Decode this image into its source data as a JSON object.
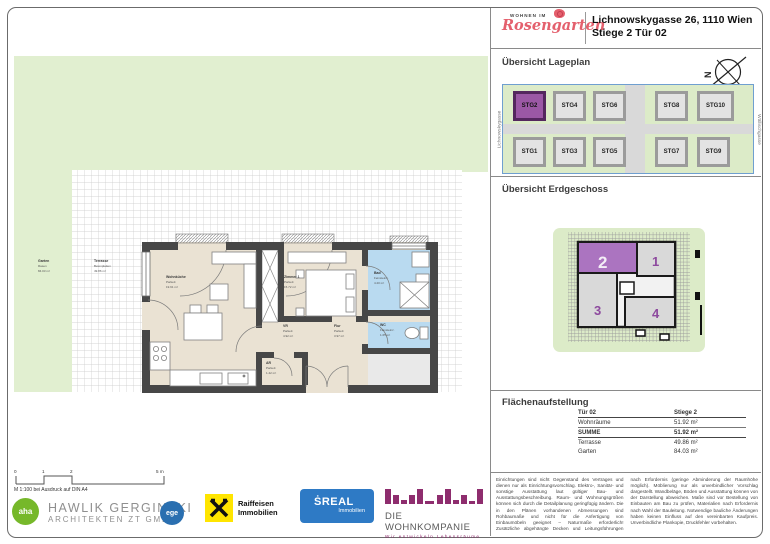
{
  "header": {
    "logo_top": "WOHNEN IM",
    "logo_script": "Rosengarten",
    "address_line1": "Lichnowskygasse 26, 1110 Wien",
    "address_line2": "Stiege 2 Tür 02"
  },
  "sections": {
    "lageplan_title": "Übersicht Lageplan",
    "erdgeschoss_title": "Übersicht Erdgeschoss",
    "flaechen_title": "Flächenaufstellung"
  },
  "lageplan": {
    "street_left": "Lichnowskygasse",
    "street_right": "Wällischgasse",
    "north_letter": "N",
    "active_building": "STG2",
    "top_row": [
      {
        "label": "STG2"
      },
      {
        "label": "STG4"
      },
      {
        "label": "STG6"
      },
      {
        "label": "STG8"
      },
      {
        "label": "STG10"
      }
    ],
    "bottom_row": [
      {
        "label": "STG1"
      },
      {
        "label": "STG3"
      },
      {
        "label": "STG5"
      },
      {
        "label": "STG7"
      },
      {
        "label": "STG9"
      }
    ]
  },
  "erdgeschoss": {
    "unit1": "1",
    "unit2": "2",
    "unit3": "3",
    "unit4": "4"
  },
  "flaechen": {
    "col_tuer": "Tür 02",
    "col_stiege": "Stiege 2",
    "rows": [
      {
        "label": "Wohnräume",
        "value": "51.92 m²"
      },
      {
        "label": "SUMME",
        "value": "51.92 m²"
      },
      {
        "label": "Terrasse",
        "value": "49.86 m²"
      },
      {
        "label": "Garten",
        "value": "84.03 m²"
      }
    ]
  },
  "plan": {
    "rooms": [
      {
        "name": "Wohnküche",
        "finish": "Parkett",
        "area": "19.91 m²"
      },
      {
        "name": "Zimmer 1",
        "finish": "Parkett",
        "area": "15.72 m²"
      },
      {
        "name": "Bad",
        "finish": "Feinsteinz.",
        "area": "4.20 m²"
      },
      {
        "name": "VR",
        "finish": "Parkett",
        "area": "4.92 m²"
      },
      {
        "name": "Flur",
        "finish": "Parkett",
        "area": "3.97 m²"
      },
      {
        "name": "WC",
        "finish": "Feinsteinz.",
        "area": "1.65 m²"
      },
      {
        "name": "AR",
        "finish": "Parkett",
        "area": "1.42 m²"
      }
    ],
    "outdoor": [
      {
        "name": "Garten",
        "finish": "Rasen",
        "area": "84.03 m²"
      },
      {
        "name": "Terrasse",
        "finish": "Betonplatten",
        "area": "49.86 m²"
      }
    ],
    "scale_note": "M 1:100 bei Ausdruck auf DIN A4",
    "ticks": [
      "0",
      "1",
      "2",
      "5 m"
    ]
  },
  "footer": {
    "aha": "aha",
    "ege": "ege",
    "architect_line1": "HAWLIK GERGINSKI",
    "architect_line2": "ARCHITEKTEN ZT GMBH",
    "raiffeisen_line1": "Raiffeisen",
    "raiffeisen_line2": "Immobilien",
    "sreal_main": "ṠREAL",
    "sreal_sub": "Immobilien",
    "wohnkompanie": "DIE WOHNKOMPANIE",
    "wohnkompanie_sub": "Wir entwickeln Lebensräume",
    "legal_col1": "Einrichtungen sind nicht Gegenstand des Vertrages und dienen nur als Einrichtungsvorschlag. Elektro-, Sanitär- und sonstige Ausstattung laut gültiger Bau- und Ausstattungsbeschreibung. Raum- und Wohnungsgrößen können sich durch die Detailplanung geringfügig ändern. Die in den Plänen vorhandenen Abmessungen sind Rohbaumaße und nicht für die Anfertigung von Einbaumöbeln geeignet – Naturmaße erforderlich! Zusätzliche abgehängte Decken und Leitungsführungen nach Erfordernis (geringe Abminderung der Raumhöhe möglich).",
    "legal_col2": "Möblierung nur als unverbindlicher Vorschlag dargestellt. Wandbeläge, Böden und Ausstattung können von der Darstellung abweichen. Maße sind vor Bestellung von Einbauten am Bau zu prüfen, Materialien nach Erfordernis nach Wahl der Bauleitung. Notwendige bauliche Änderungen haben keinen Einfluss auf den vereinbarten Kaufpreis. Unverbindliche Plankopie, Druckfehler vorbehalten."
  },
  "colors": {
    "accent_purple": "#9b58a5",
    "garden_green": "#e1efd0",
    "wet_room_blue": "#b9daf0",
    "floor_beige": "#eae2d3",
    "wall_gray": "#474747",
    "brand_pink": "#e4606d",
    "sreal_blue": "#2e7ac5",
    "raiffeisen_yellow": "#ffe500",
    "wohnkompanie_purple": "#8e2d6e"
  }
}
